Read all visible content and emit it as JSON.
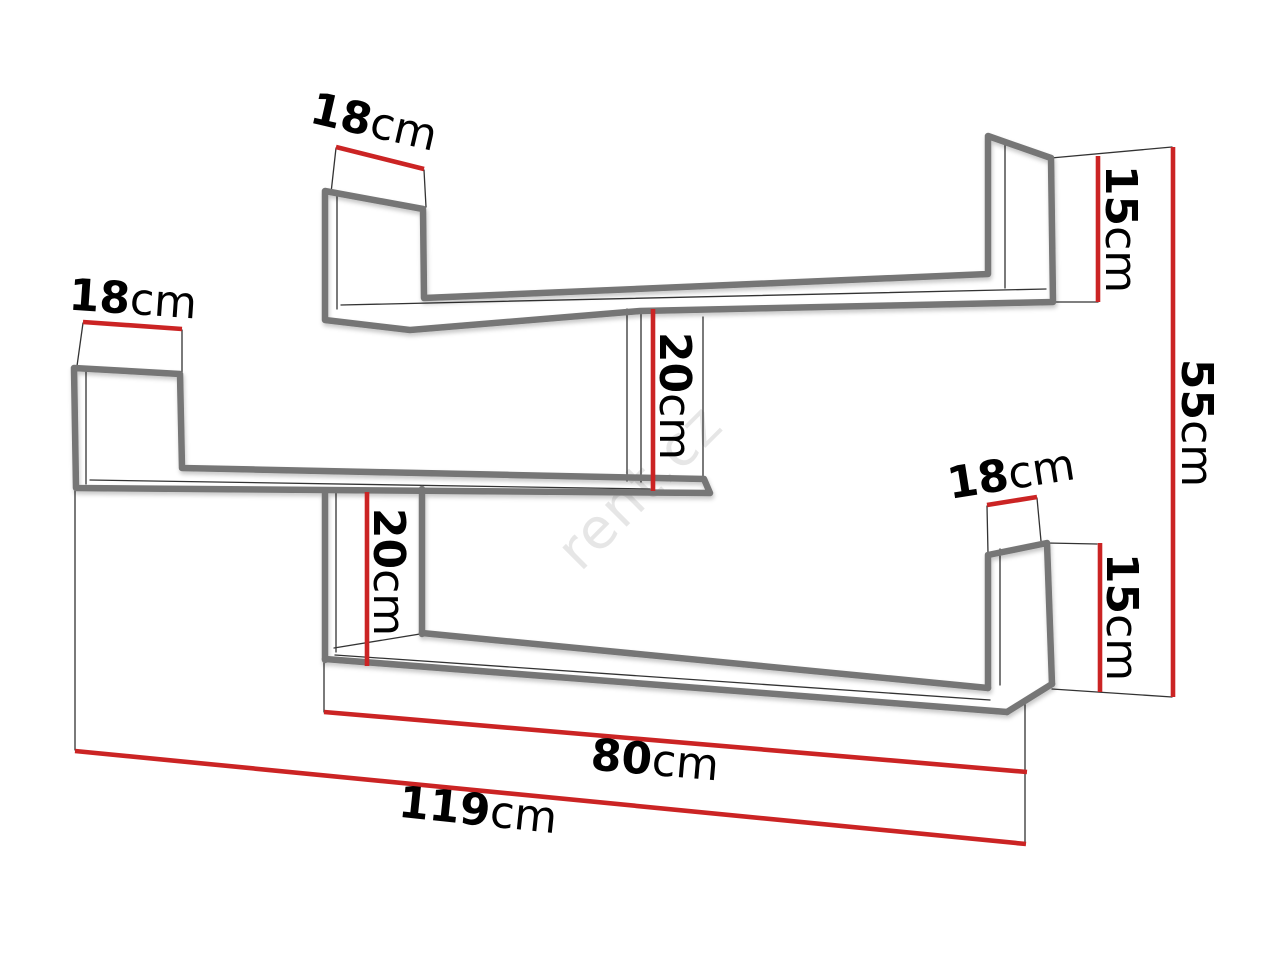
{
  "diagram": {
    "type": "furniture-dimension-drawing",
    "subject": "zigzag wall shelf",
    "watermark": {
      "text": "rent.cz"
    },
    "colors": {
      "dimension_line": "#cb2424",
      "outline_thick": "#767676",
      "outline_thin": "#333333",
      "watermark": "#e4e4e4",
      "background": "#ffffff",
      "text": "#000000"
    },
    "dimensions": [
      {
        "id": "top-shelf-depth",
        "number": "18",
        "unit": "cm",
        "value_cm": 18,
        "x": 374,
        "y": 122,
        "rotation": 13,
        "size": 44
      },
      {
        "id": "middle-shelf-depth",
        "number": "18",
        "unit": "cm",
        "value_cm": 18,
        "x": 133,
        "y": 299,
        "rotation": 4,
        "size": 44
      },
      {
        "id": "top-right-end-height",
        "number": "15",
        "unit": "cm",
        "value_cm": 15,
        "x": 1121,
        "y": 229,
        "rotation": 90,
        "size": 44
      },
      {
        "id": "overall-height",
        "number": "55",
        "unit": "cm",
        "value_cm": 55,
        "x": 1197,
        "y": 423,
        "rotation": 90,
        "size": 44
      },
      {
        "id": "upper-divider-height",
        "number": "20",
        "unit": "cm",
        "value_cm": 20,
        "x": 675,
        "y": 396,
        "rotation": 90,
        "size": 44
      },
      {
        "id": "lower-divider-height",
        "number": "20",
        "unit": "cm",
        "value_cm": 20,
        "x": 389,
        "y": 572,
        "rotation": 90,
        "size": 44
      },
      {
        "id": "bottom-right-depth",
        "number": "18",
        "unit": "cm",
        "value_cm": 18,
        "x": 1011,
        "y": 474,
        "rotation": -9,
        "size": 44
      },
      {
        "id": "bottom-right-height",
        "number": "15",
        "unit": "cm",
        "value_cm": 15,
        "x": 1122,
        "y": 617,
        "rotation": 90,
        "size": 44
      },
      {
        "id": "bottom-shelf-width",
        "number": "80",
        "unit": "cm",
        "value_cm": 80,
        "x": 655,
        "y": 760,
        "rotation": 5,
        "size": 44
      },
      {
        "id": "overall-width",
        "number": "119",
        "unit": "cm",
        "value_cm": 119,
        "x": 478,
        "y": 810,
        "rotation": 6,
        "size": 44
      }
    ]
  }
}
